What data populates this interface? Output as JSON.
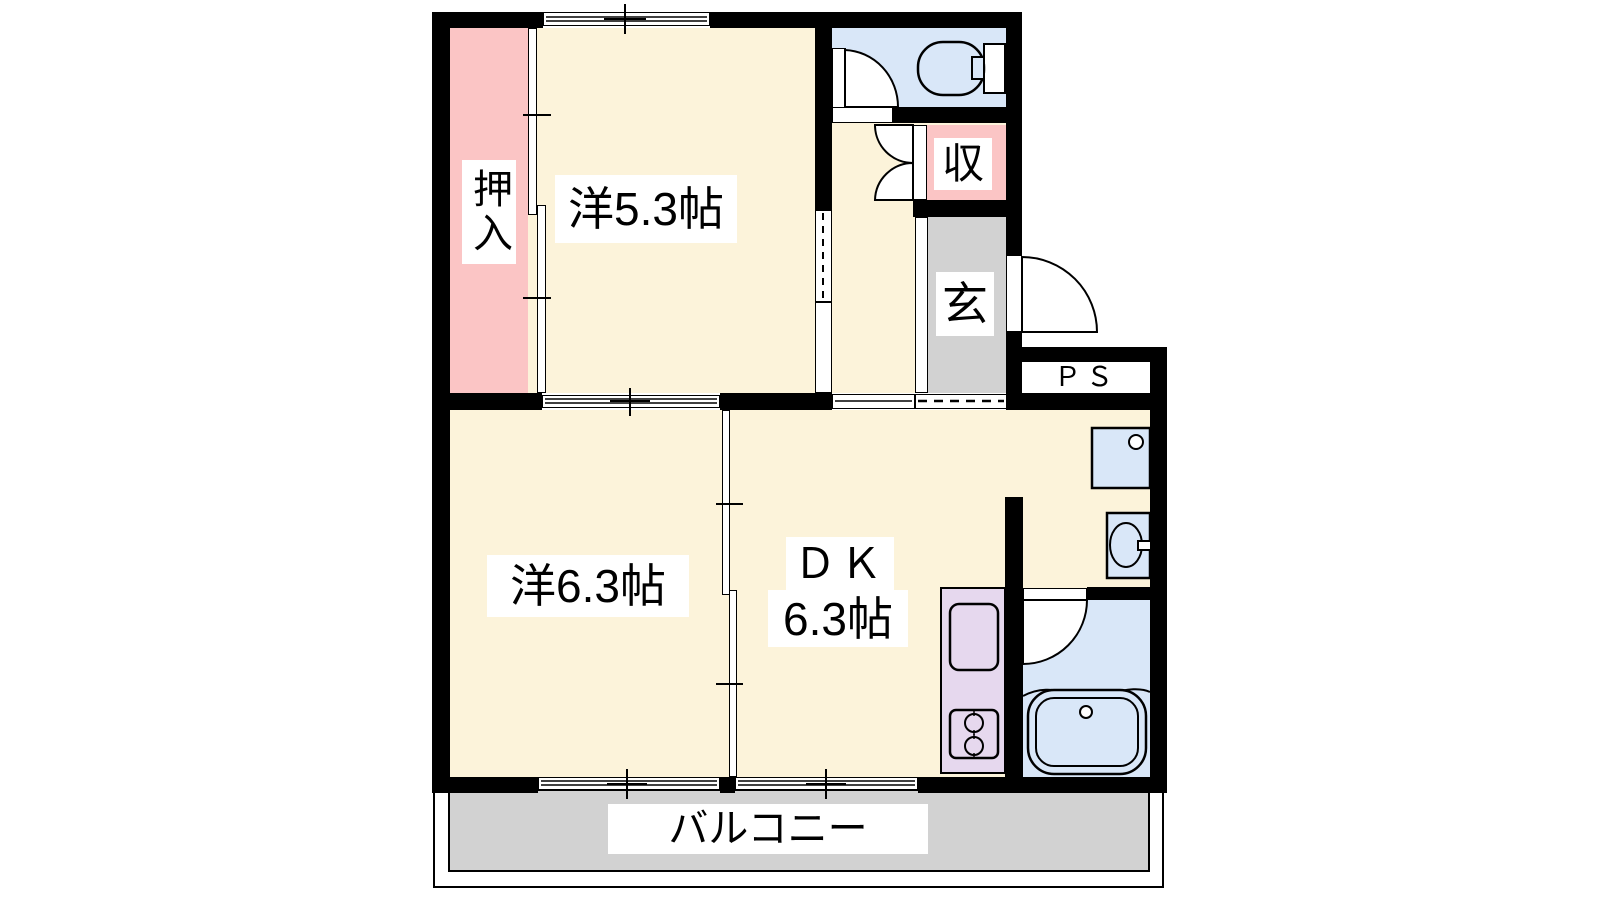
{
  "floorplan": {
    "type": "apartment-floor-plan",
    "labels": {
      "oshiire": "押入",
      "room_a": "洋5.3帖",
      "storage": "収",
      "entrance": "玄",
      "pipe_space": "ＰＳ",
      "room_b": "洋6.3帖",
      "dk_name": "ＤＫ",
      "dk_size": "6.3帖",
      "balcony": "バルコニー"
    },
    "rooms": [
      {
        "name": "洋5.3帖",
        "kind": "western-room",
        "size_jo": 5.3
      },
      {
        "name": "洋6.3帖",
        "kind": "western-room",
        "size_jo": 6.3
      },
      {
        "name": "ＤＫ 6.3帖",
        "kind": "dining-kitchen",
        "size_jo": 6.3
      },
      {
        "name": "押入",
        "kind": "closet"
      },
      {
        "name": "収",
        "kind": "storage"
      },
      {
        "name": "玄",
        "kind": "entrance"
      },
      {
        "name": "ＰＳ",
        "kind": "pipe-space"
      },
      {
        "name": "バルコニー",
        "kind": "balcony"
      }
    ],
    "fixtures": [
      "toilet-icon",
      "bathtub-icon",
      "washbasin-icon",
      "kitchen-sink-icon",
      "stove-icon",
      "counter-sink-icon",
      "door-swing-arcs",
      "sliding-windows"
    ],
    "colors": {
      "room_cream": "#fcf3da",
      "closet_pink": "#fbc5c5",
      "wet_blue": "#d9e7f8",
      "entry_gray": "#d2d2d2",
      "counter_lavender": "#e6d8ee",
      "balcony_gray": "#d2d2d2",
      "wall_black": "#000000"
    }
  }
}
